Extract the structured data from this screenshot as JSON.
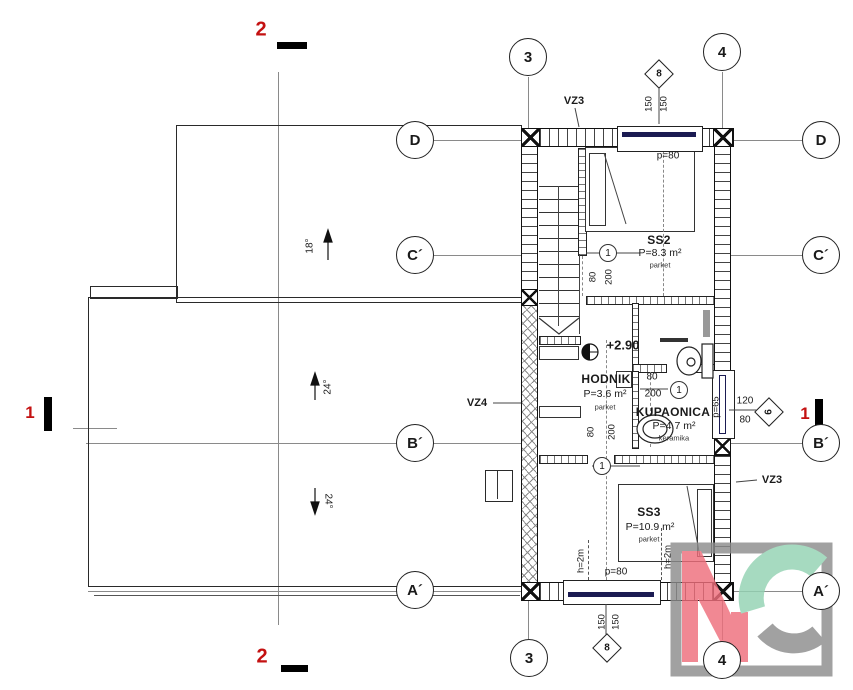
{
  "plan": {
    "title": "attic floor plan",
    "section_marks": {
      "two": "2",
      "one": "1"
    },
    "grid": {
      "c3": "3",
      "c4": "4",
      "rD": "D",
      "rC": "C´",
      "rB": "B´",
      "rA": "A´"
    },
    "rooms": {
      "ss2": {
        "name": "SS2",
        "area": "P=8.3 m²",
        "floor": "parket"
      },
      "hodnik": {
        "name": "HODNIK",
        "area": "P=3.6 m²",
        "floor": "parket"
      },
      "kupaonica": {
        "name": "KUPAONICA",
        "area": "P=4.7 m²",
        "floor": "keramika"
      },
      "ss3": {
        "name": "SS3",
        "area": "P=10.9 m²",
        "floor": "parket"
      }
    },
    "walls": {
      "vz3": "VZ3",
      "vz4": "VZ4"
    },
    "elevation": "+2.90",
    "dims": {
      "d150": "150",
      "d120": "120",
      "d80": "80",
      "d200": "200",
      "p80": "p=80",
      "p65": "p=65",
      "h2m": "h=2m"
    },
    "slopes": {
      "s18": "18°",
      "s24": "24°"
    },
    "marks": {
      "door": "1",
      "window8": "8",
      "window6": "6"
    },
    "colors": {
      "section_red": "#c41111",
      "window_navy": "#1b1b52",
      "logo_pink": "#ef6e7c",
      "logo_mint": "#93d3b3",
      "logo_gray": "#8d8d8d"
    }
  }
}
